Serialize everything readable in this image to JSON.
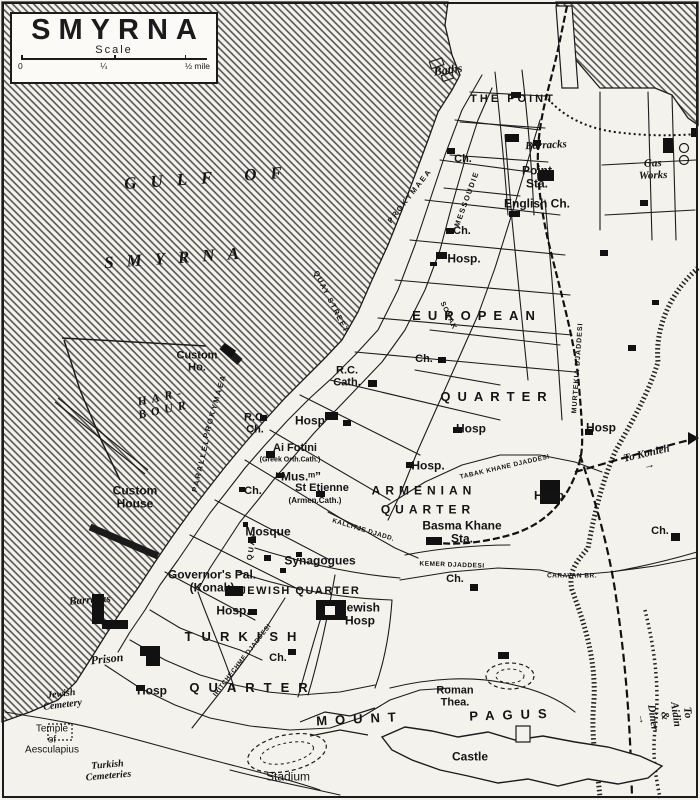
{
  "title_box": {
    "title": "SMYRNA",
    "scale_label": "Scale",
    "tick_zero": "0",
    "tick_quarter": "¼",
    "tick_half": "½ mile"
  },
  "colors": {
    "ink": "#1b1b1b",
    "paper": "#f4f2ec",
    "water_hatch": "#4a4a4a"
  },
  "labels": [
    {
      "name": "gulf-of-label",
      "text": "GULF OF",
      "x": 210,
      "y": 178,
      "cls": "water",
      "rot": -4,
      "ls": 14
    },
    {
      "name": "gulf-smyrna-label",
      "text": "SMYRNA",
      "x": 178,
      "y": 258,
      "cls": "water",
      "rot": -4,
      "ls": 13
    },
    {
      "name": "baths-label",
      "text": "Baths",
      "x": 448,
      "y": 70,
      "cls": "it",
      "rot": -8,
      "fs": 12
    },
    {
      "name": "the-point-label",
      "text": "THE POINT",
      "x": 513,
      "y": 100,
      "cls": "big",
      "ls": 3,
      "fs": 11
    },
    {
      "name": "barracks-point-label",
      "text": "Barracks",
      "x": 546,
      "y": 146,
      "cls": "it",
      "rot": -3,
      "fs": 11
    },
    {
      "name": "church-point-label",
      "text": "Ch.",
      "x": 463,
      "y": 160,
      "fs": 11
    },
    {
      "name": "point-station-label",
      "text": "Point\nSta.",
      "x": 537,
      "y": 177,
      "fs": 12
    },
    {
      "name": "english-church-label",
      "text": "English Ch.",
      "x": 537,
      "y": 204,
      "fs": 12
    },
    {
      "name": "gas-works-label",
      "text": "Gas\nWorks",
      "x": 653,
      "y": 170,
      "cls": "it",
      "rot": -2,
      "fs": 11
    },
    {
      "name": "church-2-label",
      "text": "Ch.",
      "x": 462,
      "y": 232,
      "fs": 11
    },
    {
      "name": "hospital-1-label",
      "text": "Hosp.",
      "x": 464,
      "y": 259,
      "fs": 12
    },
    {
      "name": "european-label",
      "text": "EUROPEAN",
      "x": 477,
      "y": 316,
      "cls": "big",
      "ls": 7,
      "fs": 13
    },
    {
      "name": "european-quarter-label",
      "text": "QUARTER",
      "x": 497,
      "y": 397,
      "cls": "big",
      "ls": 7,
      "fs": 13
    },
    {
      "name": "church-3-label",
      "text": "Ch.",
      "x": 424,
      "y": 360,
      "fs": 11
    },
    {
      "name": "custom-ho-label",
      "text": "Custom\nHo.",
      "x": 197,
      "y": 362,
      "fs": 11
    },
    {
      "name": "harbour-label",
      "text": "HAR-\nBOUR",
      "x": 163,
      "y": 403,
      "cls": "water2",
      "rot": -12,
      "ls": 5
    },
    {
      "name": "rc-cathedral-label",
      "text": "R.C.\nCath.",
      "x": 347,
      "y": 377,
      "fs": 11
    },
    {
      "name": "rc-church-label",
      "text": "R.C.\nCh.",
      "x": 255,
      "y": 424,
      "fs": 11
    },
    {
      "name": "hospital-2-label",
      "text": "Hosp",
      "x": 310,
      "y": 421,
      "fs": 12
    },
    {
      "name": "hospital-3-label",
      "text": "Hosp",
      "x": 471,
      "y": 429,
      "fs": 12
    },
    {
      "name": "hospital-4-label",
      "text": "Hosp",
      "x": 601,
      "y": 428,
      "fs": 12
    },
    {
      "name": "ai-fotini-label",
      "text": "Ai Fotini",
      "x": 295,
      "y": 449,
      "fs": 11
    },
    {
      "name": "ai-fotini-sub-label",
      "text": "(Greek Orth.Cath.)",
      "x": 290,
      "y": 460,
      "cls": "tiny",
      "fs": 7
    },
    {
      "name": "museum-label",
      "text": "“Mus.ᵐ”",
      "x": 298,
      "y": 477,
      "fs": 12
    },
    {
      "name": "st-etienne-label",
      "text": "St Etienne",
      "x": 322,
      "y": 489,
      "fs": 11
    },
    {
      "name": "st-etienne-sub-label",
      "text": "(Armen.Cath.)",
      "x": 315,
      "y": 501,
      "cls": "tiny",
      "fs": 8
    },
    {
      "name": "church-4-label",
      "text": "Ch.",
      "x": 253,
      "y": 492,
      "fs": 11
    },
    {
      "name": "hospital-5-label",
      "text": "Hosp.",
      "x": 428,
      "y": 466,
      "fs": 12
    },
    {
      "name": "armenian-label",
      "text": "ARMENIAN",
      "x": 424,
      "y": 491,
      "cls": "big",
      "ls": 5,
      "fs": 12
    },
    {
      "name": "armenian-quarter-label",
      "text": "QUARTER",
      "x": 428,
      "y": 510,
      "cls": "big",
      "ls": 5,
      "fs": 12
    },
    {
      "name": "hospital-6-label",
      "text": "Hosp",
      "x": 549,
      "y": 496,
      "fs": 12
    },
    {
      "name": "basma-khane-label",
      "text": "Basma Khane\nSta.",
      "x": 462,
      "y": 532,
      "fs": 12
    },
    {
      "name": "to-konieh-label",
      "text": "To Konieh →",
      "x": 648,
      "y": 460,
      "cls": "it",
      "rot": -13,
      "fs": 11
    },
    {
      "name": "church-5-label",
      "text": "Ch.",
      "x": 660,
      "y": 532,
      "fs": 11
    },
    {
      "name": "custom-house-label",
      "text": "Custom\nHouse",
      "x": 135,
      "y": 497,
      "fs": 12
    },
    {
      "name": "mosque-label",
      "text": "Mosque",
      "x": 268,
      "y": 532,
      "fs": 12
    },
    {
      "name": "synagogues-label",
      "text": "Synagogues",
      "x": 320,
      "y": 561,
      "fs": 12
    },
    {
      "name": "governors-palace-label",
      "text": "Governor's Pal.\n(Konak)",
      "x": 212,
      "y": 581,
      "fs": 12
    },
    {
      "name": "jewish-quarter-label",
      "text": "JEWISH QUARTER",
      "x": 300,
      "y": 592,
      "cls": "big",
      "ls": 1.5,
      "fs": 11
    },
    {
      "name": "hospital-7-label",
      "text": "Hosp.",
      "x": 233,
      "y": 611,
      "fs": 12
    },
    {
      "name": "jewish-hospital-label",
      "text": "Jewish\nHosp",
      "x": 360,
      "y": 614,
      "fs": 12
    },
    {
      "name": "barracks-left-label",
      "text": "Barracks",
      "x": 90,
      "y": 601,
      "cls": "it",
      "rot": -4,
      "fs": 11
    },
    {
      "name": "turkish-label",
      "text": "TURKISH",
      "x": 245,
      "y": 637,
      "cls": "big",
      "ls": 9,
      "fs": 13
    },
    {
      "name": "turkish-quarter-label",
      "text": "QUARTER",
      "x": 253,
      "y": 688,
      "cls": "big",
      "ls": 9,
      "fs": 13
    },
    {
      "name": "church-6-label",
      "text": "Ch.",
      "x": 278,
      "y": 659,
      "fs": 11
    },
    {
      "name": "prison-label",
      "text": "Prison",
      "x": 107,
      "y": 659,
      "cls": "it",
      "rot": -6,
      "fs": 12
    },
    {
      "name": "jewish-cemetery-label",
      "text": "Jewish\nCemetery",
      "x": 62,
      "y": 700,
      "cls": "it",
      "rot": -7,
      "fs": 10
    },
    {
      "name": "temple-aesculapius-label",
      "text": "Temple\nof\nAesculapius",
      "x": 52,
      "y": 740,
      "cls": "plain",
      "fs": 10
    },
    {
      "name": "turkish-cemeteries-label",
      "text": "Turkish\nCemeteries",
      "x": 108,
      "y": 771,
      "cls": "it",
      "rot": -5,
      "fs": 10
    },
    {
      "name": "hospital-8-label",
      "text": "Hosp",
      "x": 152,
      "y": 691,
      "fs": 12
    },
    {
      "name": "roman-theatre-label",
      "text": "Roman\nThea.",
      "x": 455,
      "y": 697,
      "fs": 11
    },
    {
      "name": "mount-label",
      "text": "MOUNT",
      "x": 360,
      "y": 719,
      "cls": "big",
      "ls": 8,
      "fs": 13,
      "rot": -3
    },
    {
      "name": "pagus-label",
      "text": "PAGUS",
      "x": 512,
      "y": 715,
      "cls": "big",
      "ls": 8,
      "fs": 13,
      "rot": -2
    },
    {
      "name": "castle-label",
      "text": "Castle",
      "x": 470,
      "y": 757,
      "fs": 12
    },
    {
      "name": "stadium-label",
      "text": "Stadium",
      "x": 288,
      "y": 777,
      "cls": "plain",
      "fs": 12
    },
    {
      "name": "caravan-bridge-label",
      "text": "CARAVAN BR.",
      "x": 572,
      "y": 577,
      "cls": "street",
      "fs": 6.5,
      "ls": 0.5
    },
    {
      "name": "church-7-label",
      "text": "Ch.",
      "x": 455,
      "y": 580,
      "fs": 11
    },
    {
      "name": "to-aidin-label",
      "text": "To Aidin & Diner →",
      "x": 664,
      "y": 716,
      "cls": "it",
      "rot": 82,
      "fs": 11
    },
    {
      "name": "prokymaea-north-street-label",
      "text": "PROKYMAEA",
      "x": 410,
      "y": 196,
      "cls": "street",
      "rot": -52,
      "fs": 7.5,
      "ls": 2
    },
    {
      "name": "prokymaea-south-street-label",
      "text": "PROKYMAEA",
      "x": 215,
      "y": 406,
      "cls": "street",
      "rot": -74,
      "fs": 7.5,
      "ls": 2
    },
    {
      "name": "parallel-street-label",
      "text": "PARALLEL",
      "x": 201,
      "y": 465,
      "cls": "street",
      "rot": -77,
      "fs": 7.5,
      "ls": 2
    },
    {
      "name": "quay-street-vertical-label",
      "text": "QUAY",
      "x": 252,
      "y": 546,
      "cls": "street",
      "rot": -80,
      "fs": 7.5,
      "ls": 2
    },
    {
      "name": "quay-street-label",
      "text": "QUAY STREET",
      "x": 331,
      "y": 302,
      "cls": "street",
      "rot": 63,
      "fs": 7.5,
      "ls": 1.5
    },
    {
      "name": "messoudie-street-label",
      "text": "MESSOUDIE",
      "x": 467,
      "y": 199,
      "cls": "street",
      "rot": -70,
      "fs": 7.5,
      "ls": 1.5
    },
    {
      "name": "murtekia-street-label",
      "text": "MURTEKIA DJADDESI",
      "x": 578,
      "y": 368,
      "cls": "street",
      "rot": -86,
      "fs": 7,
      "ls": 1
    },
    {
      "name": "sokak-street-label",
      "text": "SOKAK",
      "x": 448,
      "y": 316,
      "cls": "street",
      "rot": 65,
      "fs": 7,
      "ls": 1
    },
    {
      "name": "tabak-khane-street-label",
      "text": "TABAK KHANE DJADDESI",
      "x": 505,
      "y": 468,
      "cls": "street",
      "rot": -13,
      "fs": 6.5,
      "ls": 0.5
    },
    {
      "name": "kallitje-street-label",
      "text": "KALLITJE DJADD.",
      "x": 363,
      "y": 531,
      "cls": "street",
      "rot": 17,
      "fs": 6.5,
      "ls": 0.5
    },
    {
      "name": "kemer-street-label",
      "text": "KEMER DJADDESI",
      "x": 452,
      "y": 566,
      "cls": "street",
      "rot": 2,
      "fs": 6.5,
      "ls": 0.5
    },
    {
      "name": "iritchechme-street-label",
      "text": "IRITCHECHME DJADDESI",
      "x": 243,
      "y": 661,
      "cls": "street",
      "rot": -52,
      "fs": 6.5,
      "ls": 0.5
    }
  ]
}
